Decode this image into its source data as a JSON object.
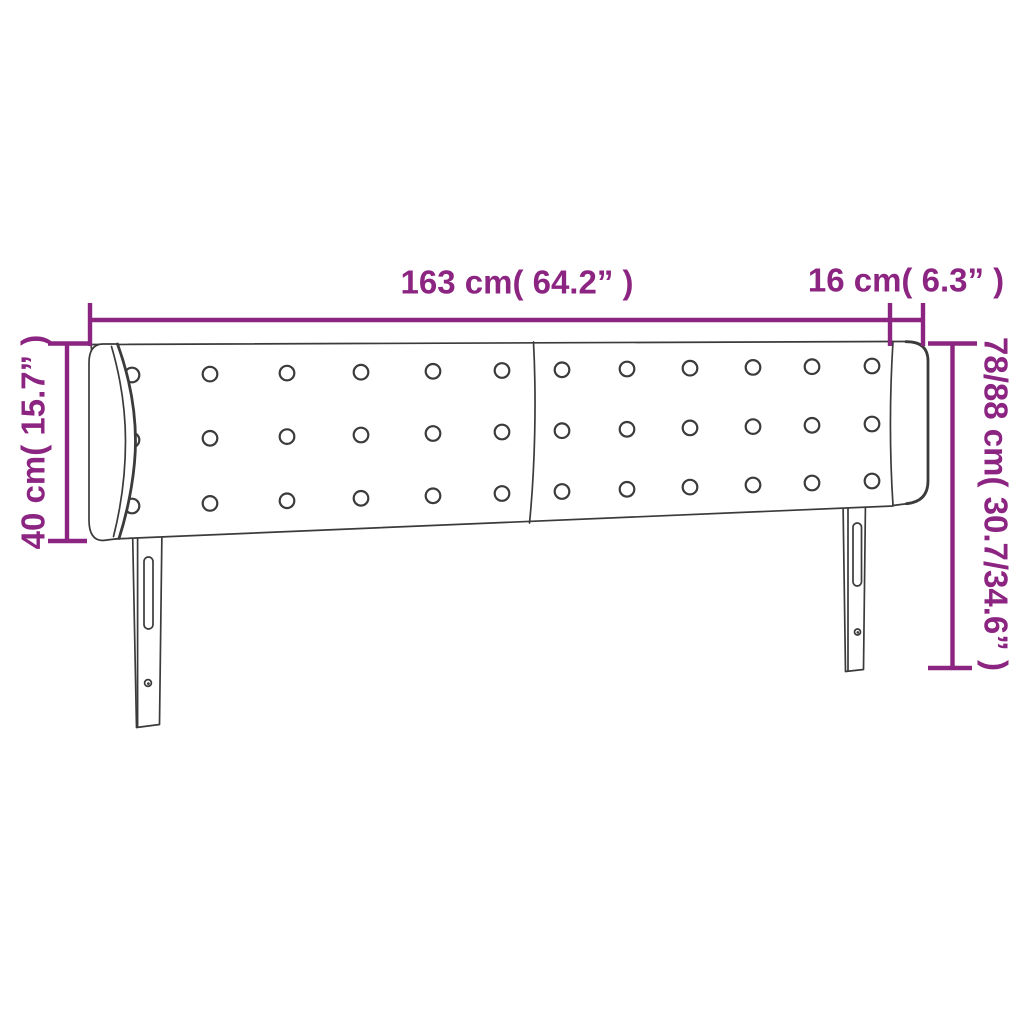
{
  "diagram": {
    "colors": {
      "accent": "#8c2481",
      "line": "#3b3b3b",
      "background": "#ffffff"
    },
    "labels": {
      "width_main": "163 cm( 64.2” )",
      "width_side": "16 cm( 6.3” )",
      "height_left": "40 cm( 15.7” )",
      "height_right": "78/88 cm( 30.7/34.6” )"
    }
  }
}
